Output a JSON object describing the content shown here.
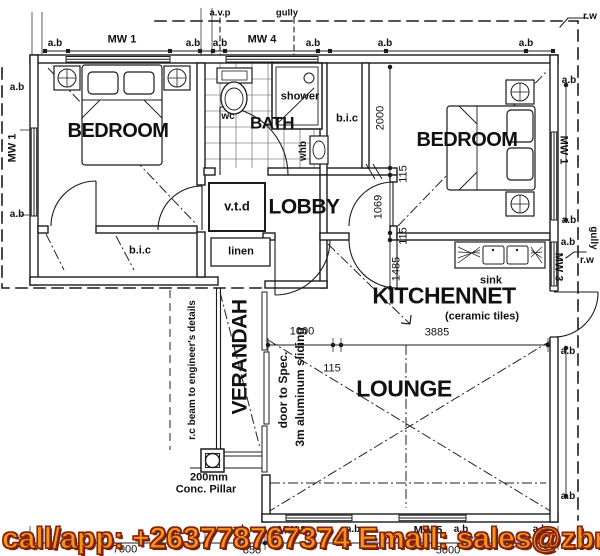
{
  "banner": {
    "text": "call/app: +263778767374   Email: sales@zbr",
    "fill_color": "#F7941E",
    "outline_color": "#7a1e08"
  },
  "rooms": {
    "bedroom": "BEDROOM",
    "bath": "BATH",
    "lobby": "LOBBY",
    "kitchennet": "KITCHENNET",
    "kitchennet_note": "(ceramic tiles)",
    "lounge": "LOUNGE",
    "verandah": "VERANDAH"
  },
  "fixtures": {
    "wc": "wc",
    "shower": "shower",
    "whb": "whb",
    "bic": "b.i.c",
    "vtd": "v.t.d",
    "linen": "linen",
    "sink": "sink"
  },
  "windows": {
    "mw1": "MW 1",
    "mw2": "MW 2",
    "mw3": "MW 3",
    "mw4": "MW 4",
    "mw5": "MW 5"
  },
  "marks": {
    "ab": "a.b",
    "avp": "a.v.p",
    "gully": "gully",
    "rw": "r.w"
  },
  "notes": {
    "rc_beam": "r.c beam to engineer's details",
    "door_spec_1": "door to Spec.",
    "door_spec_2": "3m aluminum sliding",
    "pillar_size": "200mm",
    "pillar_type": "Conc. Pillar"
  },
  "dims": {
    "d2000": "2000",
    "d115": "115",
    "d1069": "1069",
    "d1485": "1485",
    "d1000": "1000",
    "d3885": "3885",
    "d7000": "7000",
    "d850": "850",
    "d5000": "5000"
  }
}
